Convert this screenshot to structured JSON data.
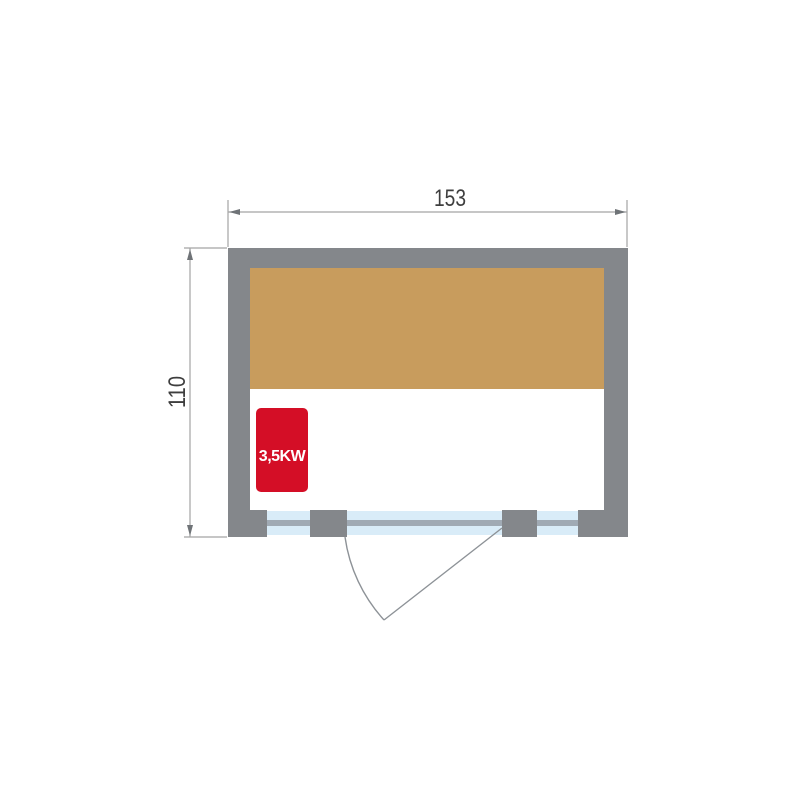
{
  "diagram": {
    "width_dimension": {
      "label": "153"
    },
    "height_dimension": {
      "label": "110"
    },
    "heater": {
      "label": "3,5KW"
    },
    "colors": {
      "wall_gray": "#84878b",
      "bench_wood": "#c89c5d",
      "heater_red": "#d40e26",
      "heater_text_white": "#ffffff",
      "glass_blue": "#d9ecf8",
      "door_track_gray": "#a0aab4",
      "dimension_line_gray": "#a3a3a3",
      "dimension_arrow_gray": "#6f7377",
      "dimension_text_gray": "#3e3e3e",
      "door_swing_line_gray": "#8d9297"
    }
  }
}
